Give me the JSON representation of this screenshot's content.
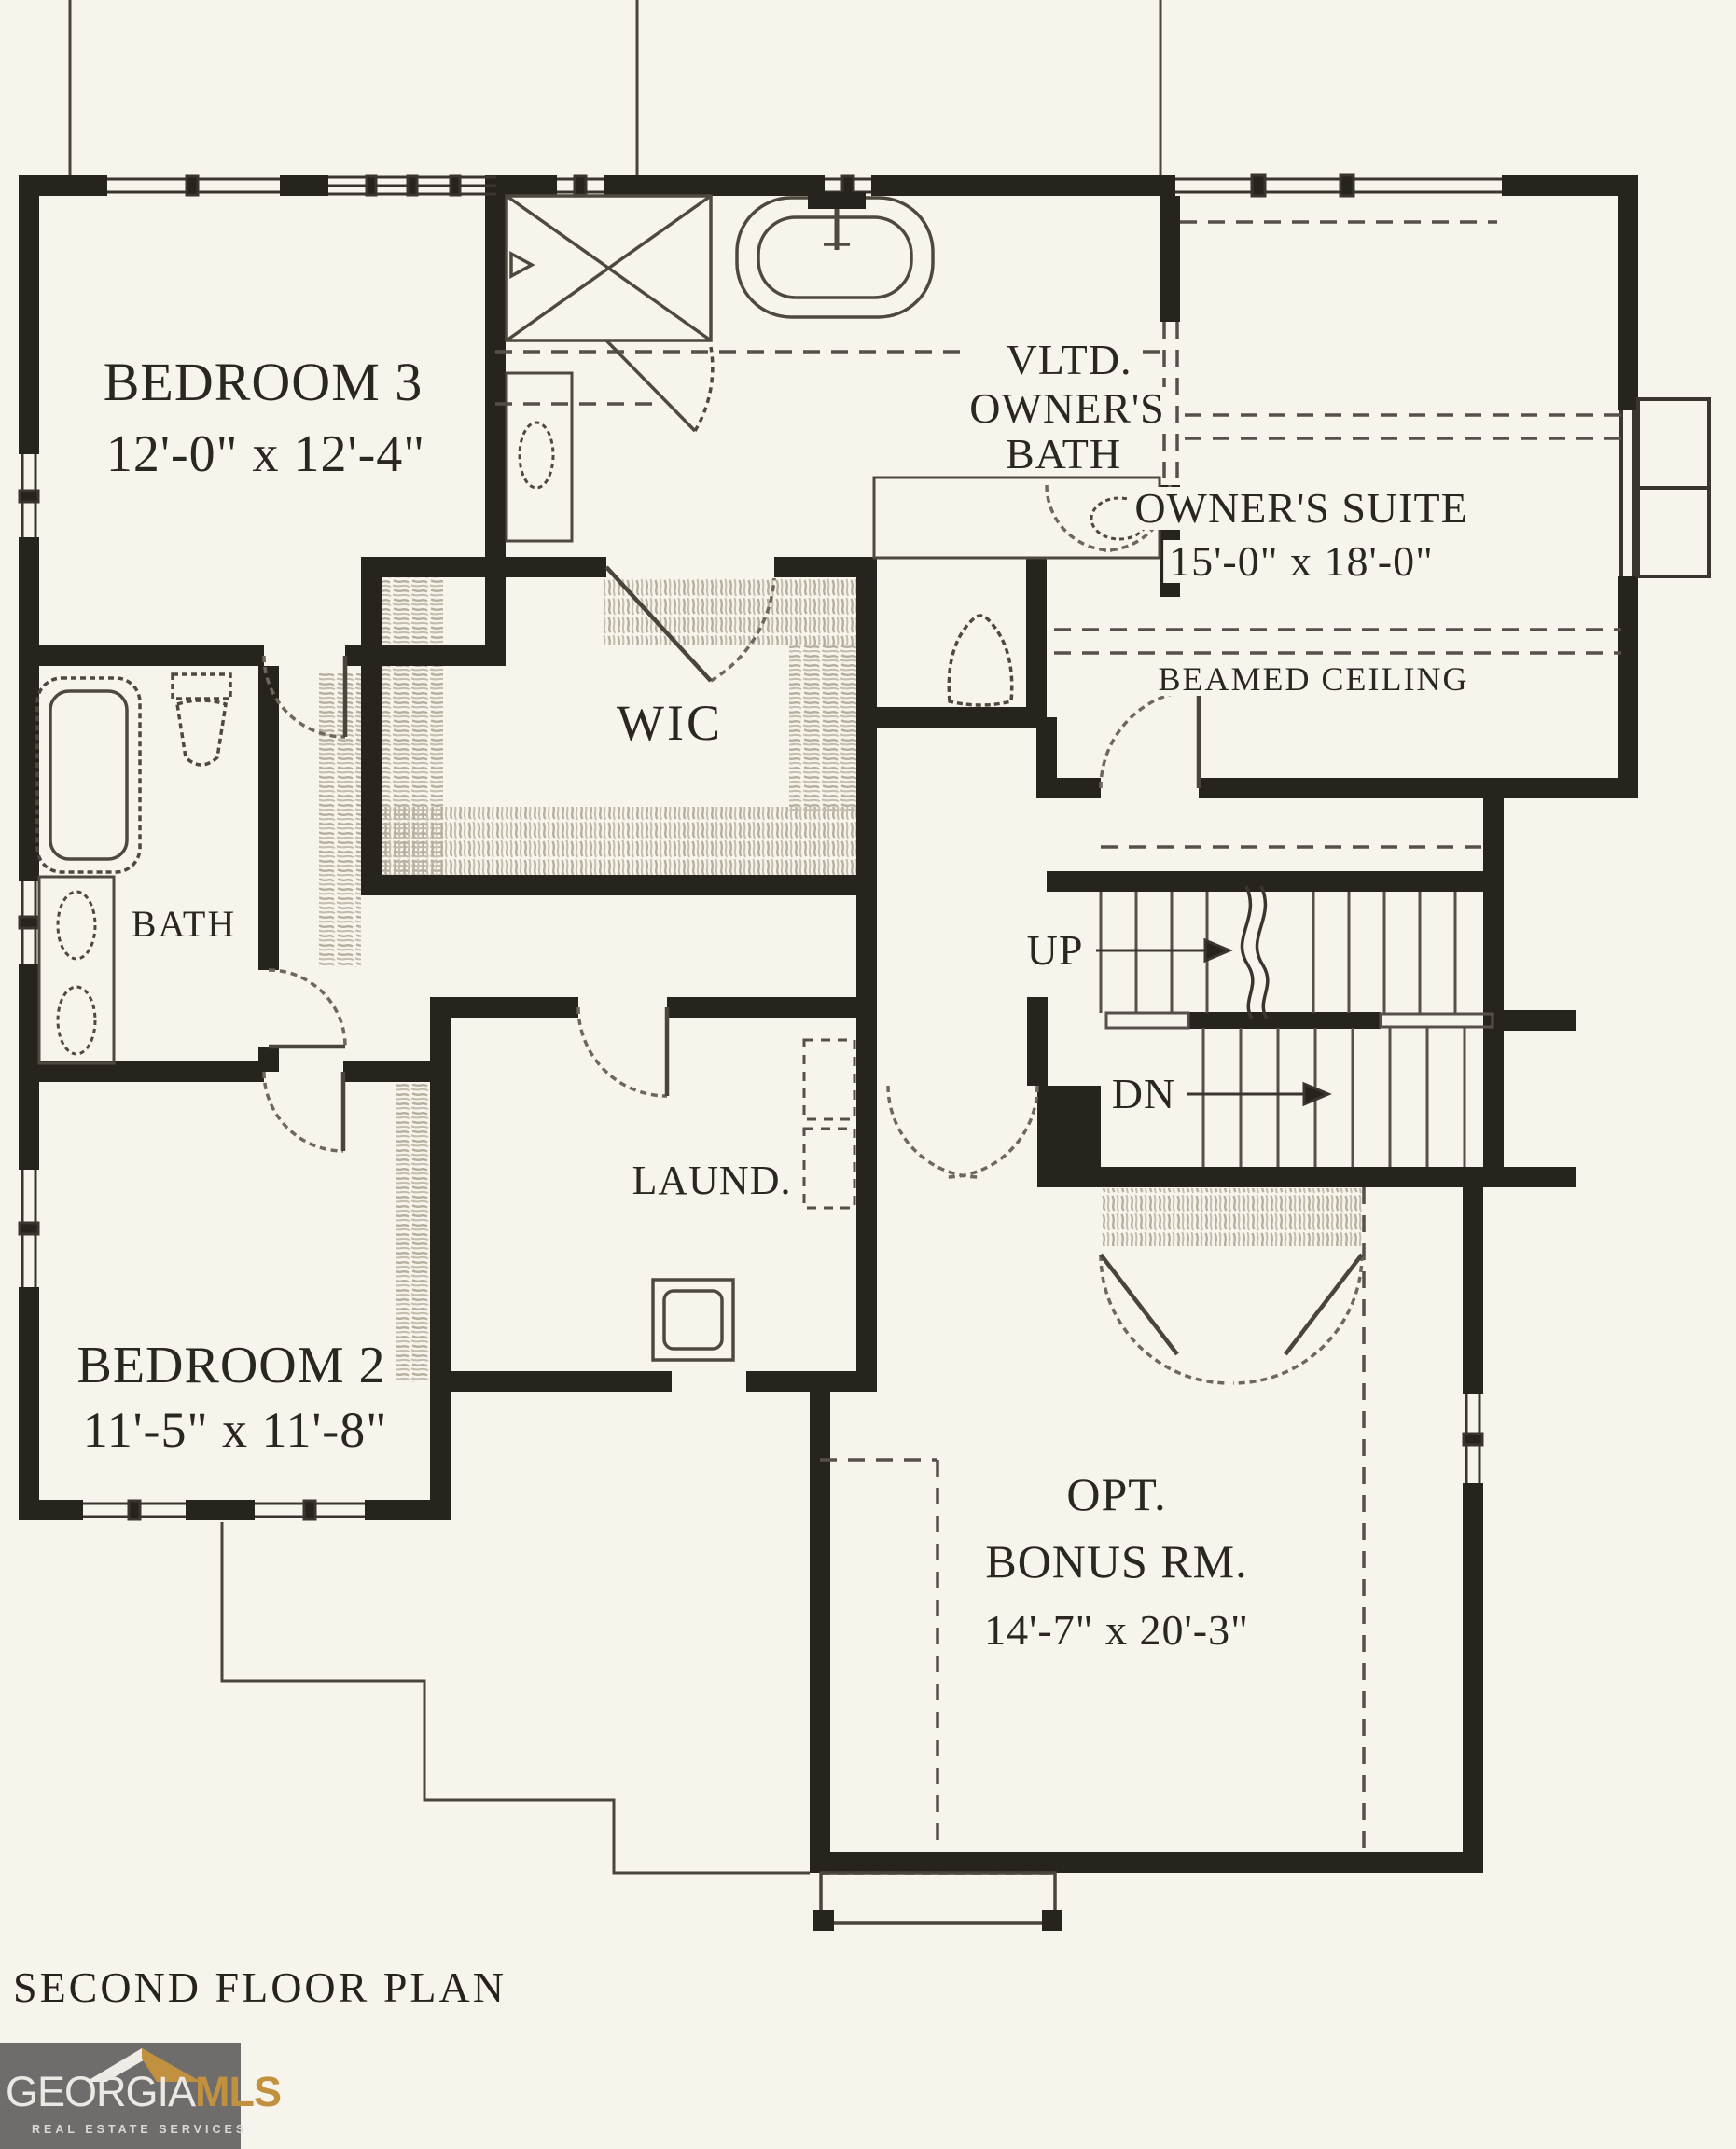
{
  "title": "SECOND FLOOR PLAN",
  "logo": {
    "brand": "GEORGIA",
    "brand2": "MLS",
    "tagline": "REAL ESTATE SERVICES"
  },
  "rooms": {
    "bedroom3": {
      "name": "BEDROOM 3",
      "dims": "12'-0\" x 12'-4\""
    },
    "owners_bath": {
      "line1": "VLTD.",
      "line2": "OWNER'S",
      "line3": "BATH"
    },
    "owners_suite": {
      "name": "OWNER'S SUITE",
      "dims": "15'-0\" x 18'-0\"",
      "note": "BEAMED CEILING"
    },
    "wic": {
      "name": "WIC"
    },
    "bath": {
      "name": "BATH"
    },
    "bedroom2": {
      "name": "BEDROOM 2",
      "dims": "11'-5\" x 11'-8\""
    },
    "laundry": {
      "name": "LAUND."
    },
    "bonus": {
      "line1": "OPT.",
      "line2": "BONUS RM.",
      "dims": "14'-7\" x 20'-3\""
    }
  },
  "stairs": {
    "up": "UP",
    "down": "DN"
  },
  "colors": {
    "paper": "#f7f4eb",
    "ink": "#27241e",
    "hatch": "#b6af9f",
    "logo_bg": "#6f6d6b",
    "logo_gold": "#c2913f"
  }
}
